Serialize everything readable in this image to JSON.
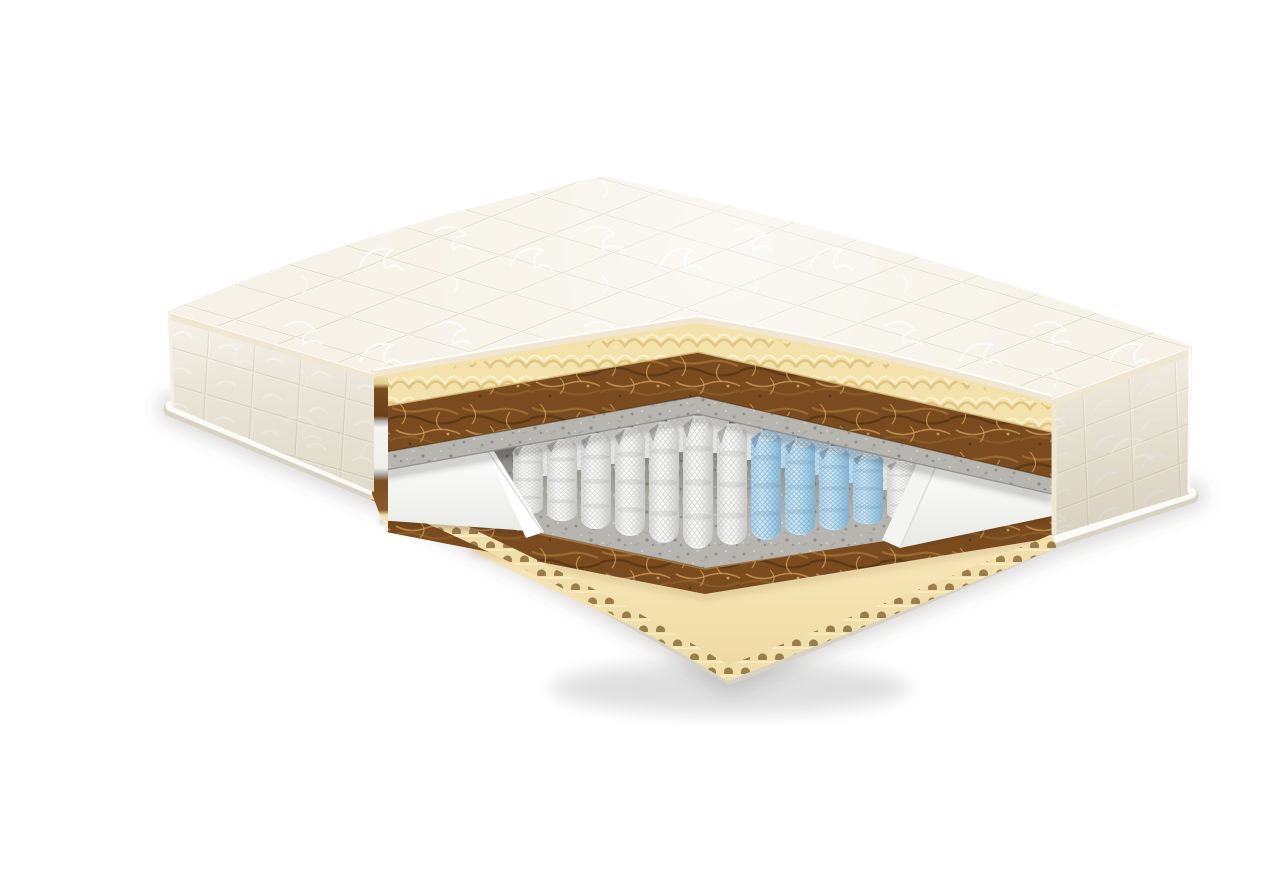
{
  "image": {
    "description": "3D cutaway render of a two-sided mattress showing its internal layers: quilted cover, wavy foam, coconut coir, felt, pocket springs with a blue comfort zone, foam encasement and base foam with egg-crate edge."
  },
  "colors": {
    "background": "#ffffff",
    "quilt_top": "#f6f2e7",
    "quilt_side_left": "#f0ebdd",
    "quilt_side_right": "#ece5d5",
    "quilt_seam": "#ddd3bb",
    "quilt_swirl": "#ffffff",
    "tape": "#efe7d1",
    "foam_wave": "#f3e2ab",
    "foam_wave_shadow": "#dfc685",
    "foam_wave_highlight": "#fbf1cd",
    "coir": "#7a4b1e",
    "coir_fiber_light": "#9c6a30",
    "coir_fiber_lighter": "#b98a4b",
    "coir_fiber_dark": "#5d3a16",
    "felt": "#b7b5b0",
    "felt_speckle_dark": "#8f8d87",
    "felt_speckle_light": "#d8d6d0",
    "spring_white": "#f7f7f5",
    "spring_blue": "#aed5ee",
    "encasement": "#fbfbf9",
    "base_foam": "#f8e8bc",
    "base_foam_deep": "#eed8a0",
    "scallop_foam": "#f1dfab",
    "scallop_hole": "#8f7340",
    "base_strip": "#fcfbf6",
    "base_strip_edge": "#d7d2c3",
    "shadow": "#000000"
  },
  "layers": [
    {
      "name": "quilted-cover",
      "label": "Quilted knit cover"
    },
    {
      "name": "wave-foam",
      "label": "Wavy comfort foam"
    },
    {
      "name": "coir-upper",
      "label": "Coconut coir board"
    },
    {
      "name": "felt-upper",
      "label": "Felt pad"
    },
    {
      "name": "pocket-springs",
      "label": "Pocket spring unit"
    },
    {
      "name": "comfort-zone",
      "label": "Blue comfort-zone springs"
    },
    {
      "name": "foam-encasement",
      "label": "Foam side encasement"
    },
    {
      "name": "felt-lower",
      "label": "Felt pad"
    },
    {
      "name": "coir-lower",
      "label": "Coconut coir board"
    },
    {
      "name": "base-foam",
      "label": "Egg-crate base foam"
    }
  ],
  "springs": {
    "front": [
      {
        "x": 488,
        "top": 428,
        "bottom": 499,
        "variant": "w"
      },
      {
        "x": 522,
        "top": 422,
        "bottom": 506,
        "variant": "w"
      },
      {
        "x": 556,
        "top": 416,
        "bottom": 514,
        "variant": "w"
      },
      {
        "x": 590,
        "top": 410,
        "bottom": 521,
        "variant": "w"
      },
      {
        "x": 624,
        "top": 404,
        "bottom": 528,
        "variant": "w"
      },
      {
        "x": 658,
        "top": 398,
        "bottom": 534,
        "variant": "w"
      },
      {
        "x": 692,
        "top": 406,
        "bottom": 530,
        "variant": "w"
      },
      {
        "x": 726,
        "top": 413,
        "bottom": 525,
        "variant": "b"
      },
      {
        "x": 760,
        "top": 421,
        "bottom": 520,
        "variant": "b"
      },
      {
        "x": 794,
        "top": 429,
        "bottom": 515,
        "variant": "b"
      },
      {
        "x": 828,
        "top": 436,
        "bottom": 509,
        "variant": "b"
      },
      {
        "x": 862,
        "top": 444,
        "bottom": 504,
        "variant": "w"
      },
      {
        "x": 896,
        "top": 452,
        "bottom": 498,
        "variant": "w"
      }
    ],
    "back": [
      {
        "x": 505,
        "top": 414,
        "variant": "w"
      },
      {
        "x": 539,
        "top": 408,
        "variant": "w"
      },
      {
        "x": 573,
        "top": 402,
        "variant": "w"
      },
      {
        "x": 607,
        "top": 396,
        "variant": "w"
      },
      {
        "x": 641,
        "top": 390,
        "variant": "w"
      },
      {
        "x": 675,
        "top": 391,
        "variant": "w"
      },
      {
        "x": 709,
        "top": 398,
        "variant": "w"
      },
      {
        "x": 743,
        "top": 406,
        "variant": "b"
      },
      {
        "x": 777,
        "top": 413,
        "variant": "b"
      },
      {
        "x": 811,
        "top": 421,
        "variant": "b"
      },
      {
        "x": 845,
        "top": 428,
        "variant": "w"
      },
      {
        "x": 879,
        "top": 436,
        "variant": "w"
      }
    ]
  }
}
